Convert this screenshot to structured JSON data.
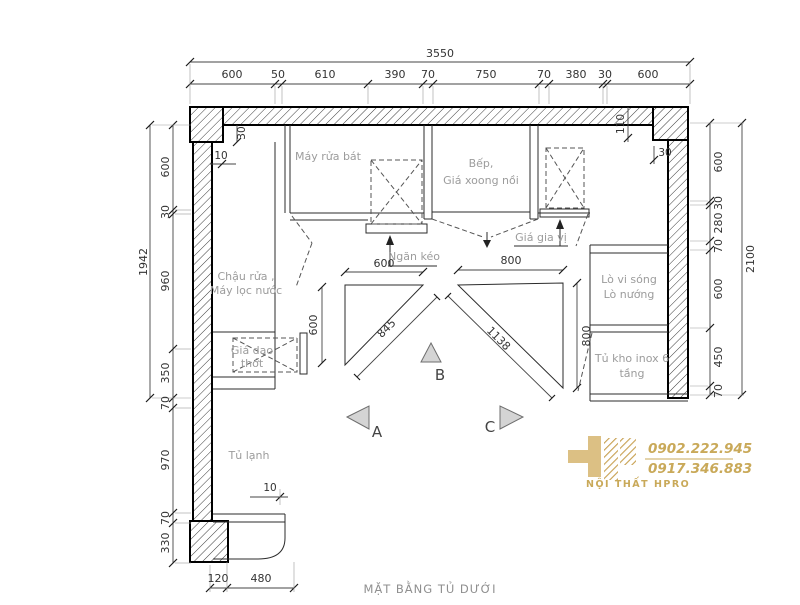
{
  "title": "MẶT BẰNG TỦ DƯỚI",
  "dim_top": {
    "total": "3550",
    "segs": [
      "600",
      "50",
      "610",
      "390",
      "70",
      "750",
      "70",
      "380",
      "30",
      "600"
    ]
  },
  "dim_left": {
    "total": "1942",
    "segs": [
      "600",
      "30",
      "960",
      "350",
      "70",
      "970",
      "70",
      "330"
    ]
  },
  "dim_right": {
    "total": "2100",
    "segs": [
      "600",
      "30",
      "280",
      "70",
      "600",
      "450",
      "70"
    ]
  },
  "dim_bottom": {
    "segs": [
      "120",
      "480"
    ]
  },
  "dim_inner": {
    "wall_tl_v": "30",
    "wall_tl_h": "10",
    "wall_tr_v": "110",
    "wall_tr_h": "30",
    "tri_left_top": "600",
    "tri_left_side": "600",
    "tri_left_hyp": "845",
    "tri_right_top": "800",
    "tri_right_side": "800",
    "tri_right_hyp": "1138",
    "fridge": "10"
  },
  "labels": {
    "may_rua_bat": "Máy rửa bát",
    "bep_1": "Bếp,",
    "bep_2": "Giá xoong nồi",
    "ngan_keo": "Ngăn kéo",
    "gia_gia_vi": "Giá gia vị",
    "chau_rua_1": "Chậu rửa ,",
    "chau_rua_2": "Máy lọc nước",
    "gia_dao_1": "Giá dao",
    "gia_dao_2": "thớt",
    "lo_1": "Lò vi sóng",
    "lo_2": "Lò nướng",
    "tu_kho_1": "Tủ kho inox 6",
    "tu_kho_2": "tầng",
    "tu_lanh": "Tủ lạnh"
  },
  "markers": {
    "a": "A",
    "b": "B",
    "c": "C"
  },
  "logo": {
    "phone1": "0902.222.945",
    "phone2": "0917.346.883",
    "name": "NỘI THẤT HPRO"
  },
  "colors": {
    "gold": "#c9a959",
    "line": "#2b2b2b",
    "label_gray": "#9c9c9c",
    "wall_hatch": "#3a3a3a"
  }
}
